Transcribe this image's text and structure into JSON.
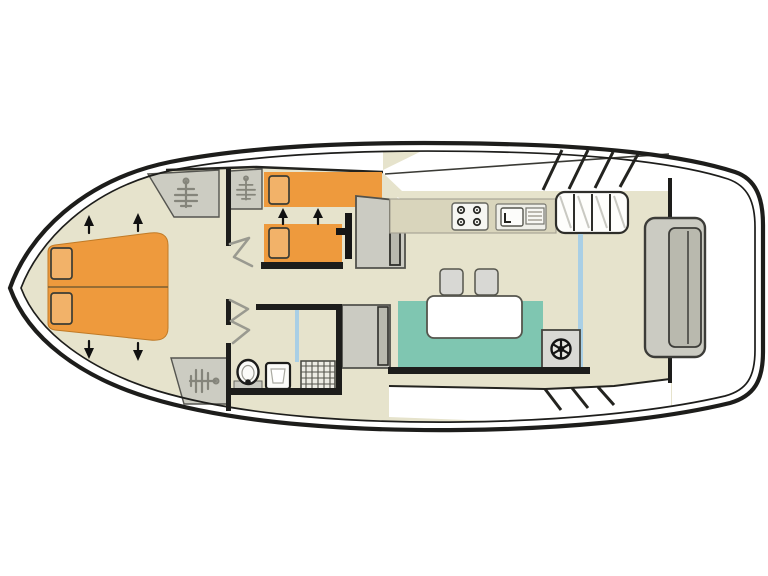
{
  "meta": {
    "diagram_type": "boat-floor-plan",
    "aria_title": "Boat interior floor plan, bow at left, stern at right",
    "orientation": "bow-left"
  },
  "colors": {
    "background": "#ffffff",
    "hull_line": "#1d1d1b",
    "wall": "#1d1d1b",
    "floor": "#e6e3cc",
    "counter": "#d9d5bc",
    "bed_orange": "#ee9a3d",
    "pillow_orange": "#f2b269",
    "sofa_teal": "#7fc6b1",
    "furniture_light": "#cbcbc2",
    "furniture_mid": "#b9b9ae",
    "wardrobe_gray": "#ccccc2",
    "glass_blue": "#a9cfe5",
    "fixture_white": "#fbfbf8",
    "hatch_gray": "#9a9a90"
  },
  "rooms": [
    {
      "id": "bow-cabin",
      "label": "Bow cabin with double V-berth"
    },
    {
      "id": "mid-cabin",
      "label": "Twin-bed cabin"
    },
    {
      "id": "bathroom",
      "label": "Bathroom with toilet, washbasin and shower"
    },
    {
      "id": "saloon",
      "label": "Saloon with galley, dinette and helm"
    },
    {
      "id": "aft-deck",
      "label": "Aft deck with bench seat"
    }
  ],
  "furniture": {
    "bow_bed": "double V-berth with two pillows",
    "wardrobes": "three wardrobes marked with coat-hanger symbol",
    "twin_beds": "two single beds with pillows",
    "conversion_arrows": "black arrows marking convertible/extending berths",
    "stove": "four-burner hob",
    "sink": "galley sink with drainer",
    "steps": "companionway steps to aft deck",
    "sofa": "bench sofa",
    "table": "dinette table",
    "stools": "two stools",
    "helm": "steering position marked with wheel symbol",
    "toilet": "toilet",
    "washbasin": "washbasin",
    "shower": "shower tray with hatched floor",
    "shower_screen": "blue shower screen",
    "patio_door": "blue door track to aft deck",
    "aft_bench": "stern bench seat",
    "door_swings": "open-door swing marks in corridor"
  }
}
